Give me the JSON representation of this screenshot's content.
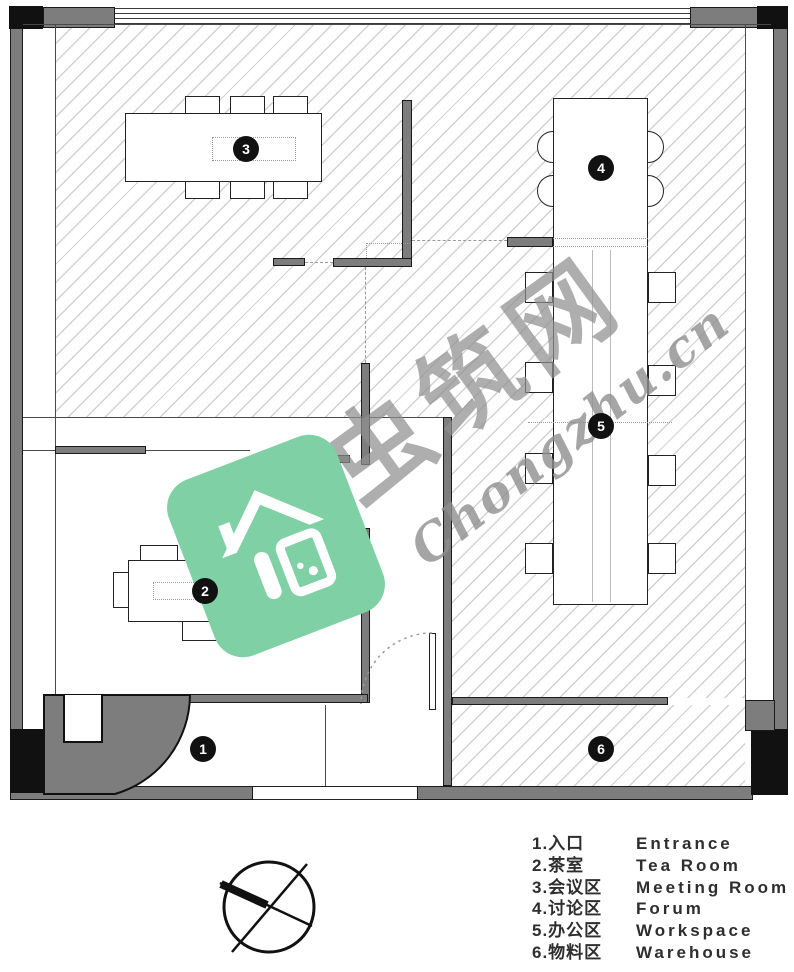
{
  "title": "office-floor-plan",
  "plan": {
    "rooms": [
      {
        "num": "1",
        "label": "1.入口",
        "en": "Entrance"
      },
      {
        "num": "2",
        "label": "2.茶室",
        "en": "Tea Room"
      },
      {
        "num": "3",
        "label": "3.会议区",
        "en": "Meeting Room"
      },
      {
        "num": "4",
        "label": "4.讨论区",
        "en": "Forum"
      },
      {
        "num": "5",
        "label": "5.办公区",
        "en": "Workspace"
      },
      {
        "num": "6",
        "label": "6.物料区",
        "en": "Warehouse"
      }
    ]
  },
  "watermark": {
    "cjk": "虫筑网",
    "latin": "Chongzhu.cn"
  },
  "colors": {
    "wall": "#7d7d7d",
    "column": "#111111",
    "hatch_line": "#d2d2d2",
    "logo_green": "#7fd1a5",
    "badge_bg": "#111111",
    "badge_text": "#ffffff",
    "watermark_gray": "#8f8f8f",
    "legend_text": "#2e2e2e"
  }
}
